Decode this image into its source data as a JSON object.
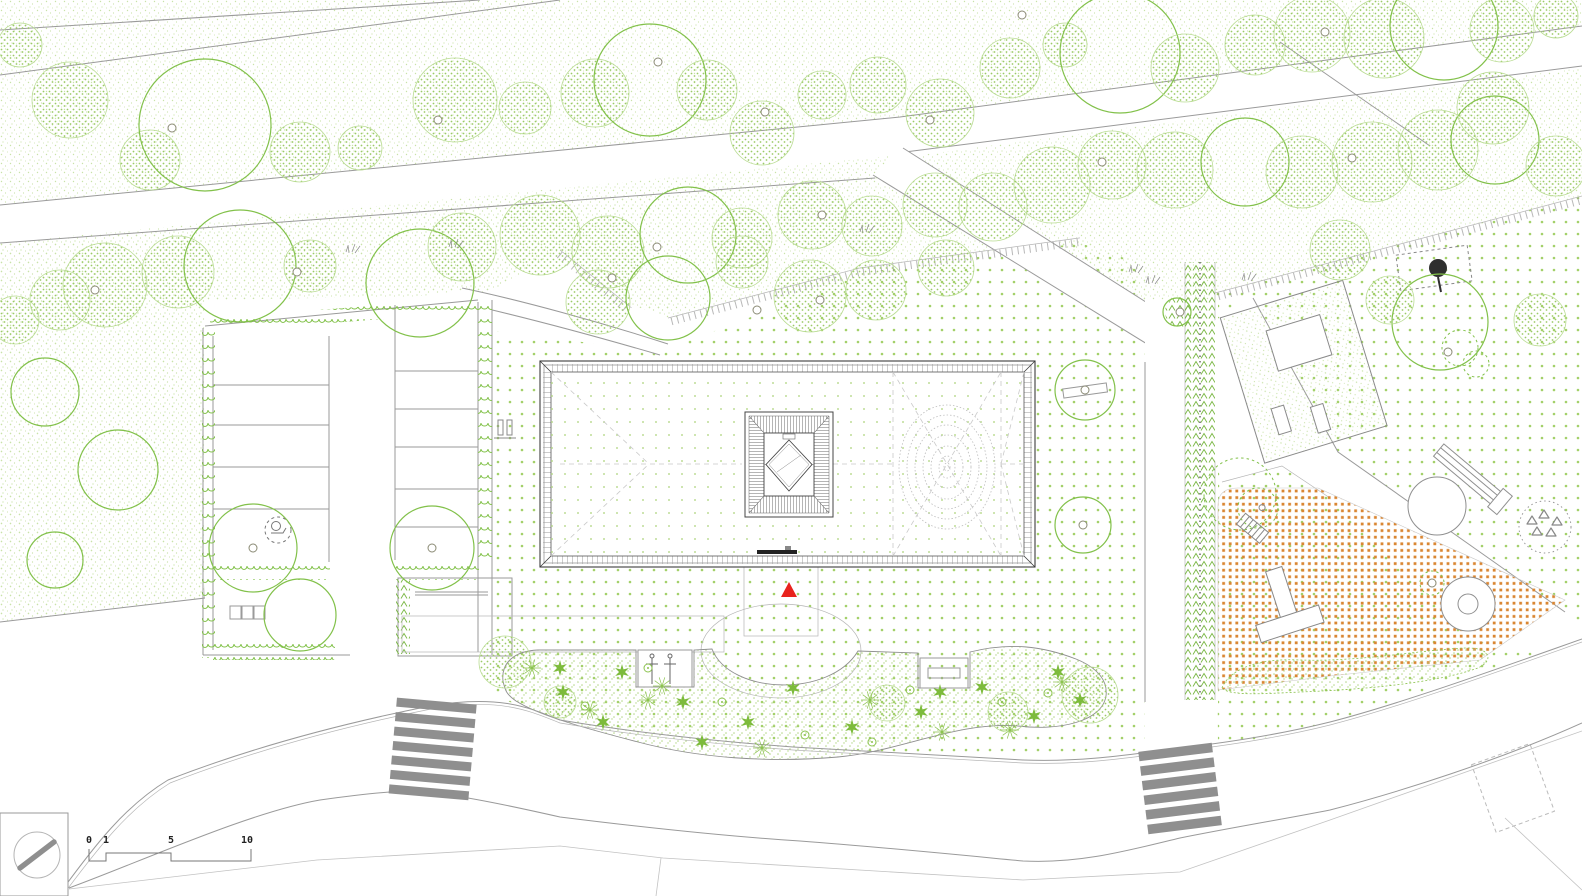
{
  "title": "Architectural landscape site plan",
  "scale_bar": {
    "labels": [
      "0",
      "1",
      "5",
      "10"
    ]
  },
  "colors": {
    "canopy_outline": "#82c14a",
    "canopy_fill": "#9ccb67",
    "canopy_light": "#b3d687",
    "stipple": "#c9e2a8",
    "lawn_dot": "#a3d069",
    "roof_dot": "#bedd97",
    "hedge_green": "#79b743",
    "flower_green": "#7dbb3c",
    "orange_surface": "#d98632",
    "road_line": "#9a9a9a",
    "building_line": "#3d3d3d",
    "crosswalk_gray": "#8f8f8f",
    "marker_red": "#e8231d",
    "dark_tree": "#2f2f2f"
  },
  "plan": {
    "trees": [
      [
        20,
        45,
        22,
        "f"
      ],
      [
        70,
        100,
        38,
        "f"
      ],
      [
        150,
        160,
        30,
        "f"
      ],
      [
        205,
        125,
        66,
        "o"
      ],
      [
        300,
        152,
        30,
        "f"
      ],
      [
        360,
        148,
        22,
        "f"
      ],
      [
        455,
        100,
        42,
        "f"
      ],
      [
        525,
        108,
        26,
        "f"
      ],
      [
        595,
        93,
        34,
        "f"
      ],
      [
        650,
        80,
        56,
        "o"
      ],
      [
        707,
        90,
        30,
        "f"
      ],
      [
        762,
        133,
        32,
        "f"
      ],
      [
        822,
        95,
        24,
        "f"
      ],
      [
        878,
        85,
        28,
        "f"
      ],
      [
        940,
        113,
        34,
        "f"
      ],
      [
        1010,
        68,
        30,
        "f"
      ],
      [
        1065,
        45,
        22,
        "f"
      ],
      [
        1120,
        53,
        60,
        "o"
      ],
      [
        1185,
        68,
        34,
        "f"
      ],
      [
        1255,
        45,
        30,
        "f"
      ],
      [
        1312,
        34,
        38,
        "f"
      ],
      [
        1384,
        38,
        40,
        "f"
      ],
      [
        1444,
        26,
        54,
        "o"
      ],
      [
        1502,
        30,
        32,
        "f"
      ],
      [
        1556,
        16,
        22,
        "f"
      ],
      [
        15,
        320,
        24,
        "f"
      ],
      [
        60,
        300,
        30,
        "f"
      ],
      [
        105,
        285,
        42,
        "f"
      ],
      [
        178,
        272,
        36,
        "f"
      ],
      [
        240,
        266,
        56,
        "o"
      ],
      [
        310,
        266,
        26,
        "f"
      ],
      [
        420,
        283,
        54,
        "o"
      ],
      [
        462,
        247,
        34,
        "f"
      ],
      [
        540,
        235,
        40,
        "f"
      ],
      [
        608,
        252,
        36,
        "f"
      ],
      [
        688,
        235,
        48,
        "o"
      ],
      [
        742,
        238,
        30,
        "f"
      ],
      [
        812,
        215,
        34,
        "f"
      ],
      [
        872,
        226,
        30,
        "f"
      ],
      [
        935,
        205,
        32,
        "f"
      ],
      [
        993,
        207,
        34,
        "f"
      ],
      [
        1052,
        185,
        38,
        "f"
      ],
      [
        1112,
        165,
        34,
        "f"
      ],
      [
        1175,
        170,
        38,
        "f"
      ],
      [
        1245,
        162,
        44,
        "o"
      ],
      [
        1302,
        172,
        36,
        "f"
      ],
      [
        1372,
        162,
        40,
        "f"
      ],
      [
        1438,
        150,
        40,
        "f"
      ],
      [
        1495,
        140,
        44,
        "o"
      ],
      [
        1556,
        166,
        30,
        "f"
      ],
      [
        1493,
        108,
        36,
        "f"
      ],
      [
        598,
        302,
        32,
        "f"
      ],
      [
        668,
        298,
        42,
        "o"
      ],
      [
        742,
        262,
        26,
        "f"
      ],
      [
        810,
        296,
        36,
        "f"
      ],
      [
        876,
        290,
        30,
        "f"
      ],
      [
        946,
        268,
        28,
        "f"
      ],
      [
        45,
        392,
        34,
        "o"
      ],
      [
        118,
        470,
        40,
        "o"
      ],
      [
        55,
        560,
        28,
        "o"
      ],
      [
        253,
        548,
        44,
        "o"
      ],
      [
        432,
        548,
        42,
        "o"
      ],
      [
        300,
        615,
        36,
        "o"
      ],
      [
        1085,
        390,
        30,
        "o"
      ],
      [
        1083,
        525,
        28,
        "o"
      ],
      [
        1177,
        312,
        14,
        "o"
      ],
      [
        1440,
        322,
        48,
        "o"
      ],
      [
        1340,
        250,
        30,
        "f"
      ],
      [
        1390,
        300,
        24,
        "f"
      ],
      [
        1540,
        320,
        26,
        "f"
      ],
      [
        1460,
        348,
        18,
        "s"
      ],
      [
        1476,
        364,
        13,
        "s"
      ],
      [
        1240,
        494,
        36,
        "s"
      ],
      [
        1258,
        508,
        20,
        "s"
      ],
      [
        1432,
        583,
        12,
        "s"
      ],
      [
        505,
        662,
        26,
        "f"
      ],
      [
        560,
        702,
        16,
        "f"
      ],
      [
        887,
        703,
        18,
        "f"
      ],
      [
        1008,
        712,
        20,
        "f"
      ],
      [
        1090,
        695,
        28,
        "f"
      ]
    ],
    "trunks": [
      [
        172,
        128
      ],
      [
        438,
        120
      ],
      [
        658,
        62
      ],
      [
        930,
        120
      ],
      [
        1022,
        15
      ],
      [
        1325,
        32
      ],
      [
        765,
        112
      ],
      [
        95,
        290
      ],
      [
        297,
        272
      ],
      [
        657,
        247
      ],
      [
        822,
        215
      ],
      [
        1102,
        162
      ],
      [
        1352,
        158
      ],
      [
        612,
        278
      ],
      [
        820,
        300
      ],
      [
        757,
        310
      ],
      [
        1448,
        352
      ],
      [
        1085,
        390
      ],
      [
        1083,
        525
      ],
      [
        1180,
        312
      ],
      [
        253,
        548
      ],
      [
        432,
        548
      ],
      [
        1432,
        583
      ]
    ],
    "flowers": {
      "stars": [
        [
          563,
          692
        ],
        [
          622,
          672
        ],
        [
          683,
          702
        ],
        [
          748,
          722
        ],
        [
          793,
          688
        ],
        [
          852,
          727
        ],
        [
          921,
          712
        ],
        [
          982,
          687
        ],
        [
          1034,
          716
        ],
        [
          1080,
          700
        ],
        [
          603,
          722
        ],
        [
          702,
          742
        ],
        [
          560,
          668
        ],
        [
          940,
          692
        ],
        [
          1058,
          672
        ]
      ],
      "bursts": [
        [
          532,
          668
        ],
        [
          662,
          686
        ],
        [
          762,
          748
        ],
        [
          942,
          732
        ],
        [
          1062,
          682
        ],
        [
          590,
          710
        ],
        [
          870,
          700
        ],
        [
          1010,
          730
        ],
        [
          648,
          700
        ]
      ],
      "rings": [
        [
          585,
          706
        ],
        [
          722,
          702
        ],
        [
          872,
          742
        ],
        [
          1002,
          702
        ],
        [
          648,
          668
        ],
        [
          805,
          735
        ],
        [
          1048,
          693
        ],
        [
          910,
          690
        ]
      ]
    },
    "tufts": [
      [
        352,
        252
      ],
      [
        455,
        247
      ],
      [
        1135,
        272
      ],
      [
        1152,
        283
      ],
      [
        1248,
        280
      ],
      [
        866,
        232
      ]
    ],
    "pebbles": [
      [
        1532,
        521
      ],
      [
        1544,
        515
      ],
      [
        1557,
        522
      ],
      [
        1537,
        532
      ],
      [
        1551,
        533
      ]
    ],
    "crosswalks": [
      {
        "x": 393,
        "y": 701,
        "width": 80,
        "height": 9,
        "gap": 5.5,
        "count": 7,
        "angle": 5,
        "cx": 433,
        "cy": 745
      },
      {
        "x": 1143,
        "y": 747,
        "width": 74,
        "height": 9.5,
        "gap": 5.2,
        "count": 6,
        "angle": -7,
        "cx": 1180,
        "cy": 788
      }
    ]
  }
}
